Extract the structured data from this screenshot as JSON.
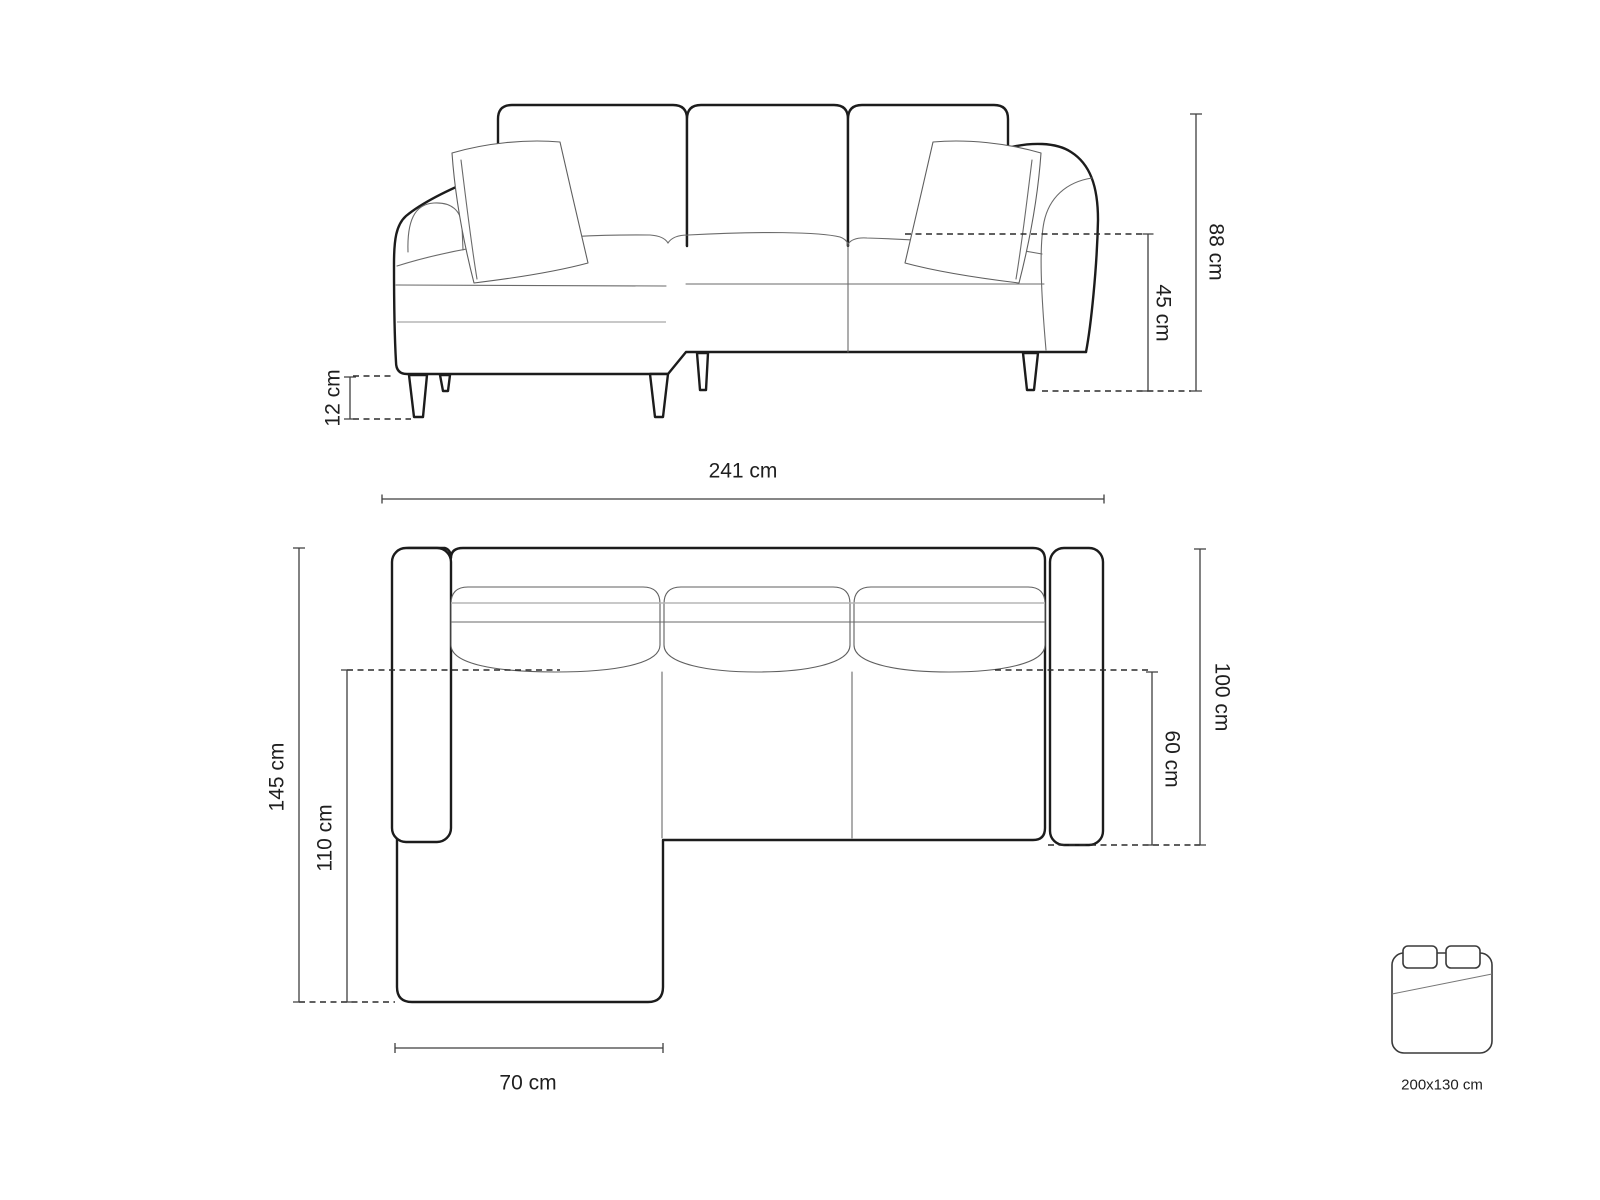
{
  "front_view": {
    "height": "88 cm",
    "seat_height": "45 cm",
    "leg_height": "12 cm"
  },
  "top_view": {
    "total_width": "241 cm",
    "total_depth": "145 cm",
    "chaise_depth": "110 cm",
    "body_depth": "100 cm",
    "seat_depth": "60 cm",
    "chaise_width": "70 cm"
  },
  "sleeping_area": {
    "size": "200x130 cm"
  },
  "colors": {
    "line": "#1c1c1c",
    "dimension": "#3f3f3f",
    "background": "#ffffff"
  }
}
